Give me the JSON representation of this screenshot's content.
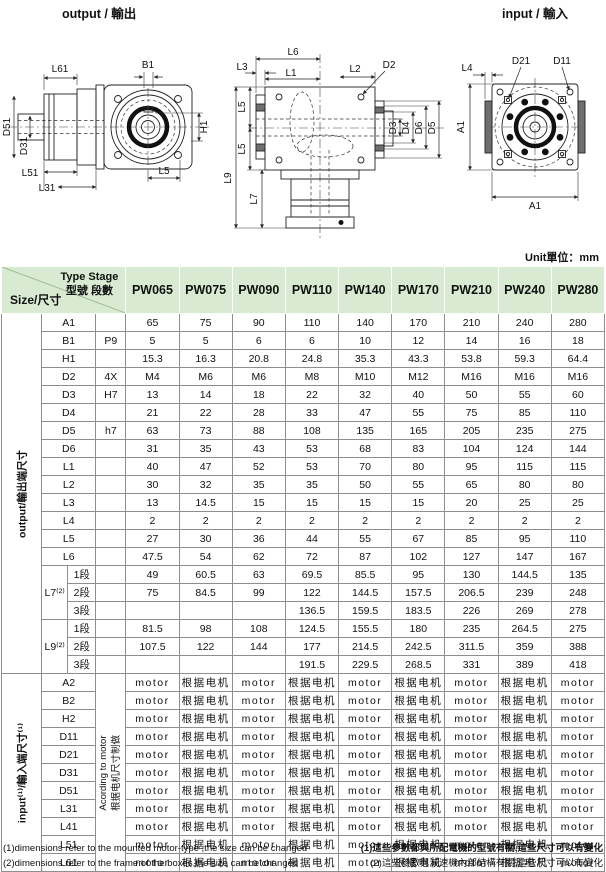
{
  "drawings": {
    "output_view": {
      "title": "output / 輸出",
      "labels": {
        "L61": "L61",
        "D51": "D51",
        "D31": "D31",
        "L51": "L51",
        "L31": "L31",
        "B1": "B1",
        "H1": "H1",
        "L5": "L5"
      }
    },
    "side_view": {
      "labels": {
        "L6": "L6",
        "L3": "L3",
        "L1": "L1",
        "L2": "L2",
        "D2": "D2",
        "L5_upper": "L5",
        "L5_lower": "L5",
        "L9": "L9",
        "L7": "L7",
        "D3": "D3",
        "D4": "D4",
        "D6": "D6",
        "D5": "D5"
      }
    },
    "input_view": {
      "title": "input / 輸入",
      "labels": {
        "L4": "L4",
        "D21": "D21",
        "D11": "D11",
        "A1_left": "A1",
        "A1_bottom": "A1"
      }
    }
  },
  "table": {
    "unit_label": "Unit單位：mm",
    "corner": {
      "type_stage_en": "Type Stage",
      "type_stage_zh": "型號 段數",
      "size_label": "Size/尺寸"
    },
    "columns": [
      "PW065",
      "PW075",
      "PW090",
      "PW110",
      "PW140",
      "PW170",
      "PW210",
      "PW240",
      "PW280"
    ],
    "output_section": {
      "label": "output/輸出端尺寸",
      "rows": [
        {
          "name": "A1",
          "qual": "",
          "values": [
            "65",
            "75",
            "90",
            "110",
            "140",
            "170",
            "210",
            "240",
            "280"
          ]
        },
        {
          "name": "B1",
          "qual": "P9",
          "values": [
            "5",
            "5",
            "6",
            "6",
            "10",
            "12",
            "14",
            "16",
            "18"
          ]
        },
        {
          "name": "H1",
          "qual": "",
          "values": [
            "15.3",
            "16.3",
            "20.8",
            "24.8",
            "35.3",
            "43.3",
            "53.8",
            "59.3",
            "64.4"
          ]
        },
        {
          "name": "D2",
          "qual": "4X",
          "values": [
            "M4",
            "M6",
            "M6",
            "M8",
            "M10",
            "M12",
            "M16",
            "M16",
            "M16"
          ]
        },
        {
          "name": "D3",
          "qual": "H7",
          "values": [
            "13",
            "14",
            "18",
            "22",
            "32",
            "40",
            "50",
            "55",
            "60"
          ]
        },
        {
          "name": "D4",
          "qual": "",
          "values": [
            "21",
            "22",
            "28",
            "33",
            "47",
            "55",
            "75",
            "85",
            "110"
          ]
        },
        {
          "name": "D5",
          "qual": "h7",
          "values": [
            "63",
            "73",
            "88",
            "108",
            "135",
            "165",
            "205",
            "235",
            "275"
          ]
        },
        {
          "name": "D6",
          "qual": "",
          "values": [
            "31",
            "35",
            "43",
            "53",
            "68",
            "83",
            "104",
            "124",
            "144"
          ]
        },
        {
          "name": "L1",
          "qual": "",
          "values": [
            "40",
            "47",
            "52",
            "53",
            "70",
            "80",
            "95",
            "115",
            "115"
          ]
        },
        {
          "name": "L2",
          "qual": "",
          "values": [
            "30",
            "32",
            "35",
            "35",
            "50",
            "55",
            "65",
            "80",
            "80"
          ]
        },
        {
          "name": "L3",
          "qual": "",
          "values": [
            "13",
            "14.5",
            "15",
            "15",
            "15",
            "15",
            "20",
            "25",
            "25"
          ]
        },
        {
          "name": "L4",
          "qual": "",
          "values": [
            "2",
            "2",
            "2",
            "2",
            "2",
            "2",
            "2",
            "2",
            "2"
          ]
        },
        {
          "name": "L5",
          "qual": "",
          "values": [
            "27",
            "30",
            "36",
            "44",
            "55",
            "67",
            "85",
            "95",
            "110"
          ]
        },
        {
          "name": "L6",
          "qual": "",
          "values": [
            "47.5",
            "54",
            "62",
            "72",
            "87",
            "102",
            "127",
            "147",
            "167"
          ]
        }
      ],
      "groups": [
        {
          "name": "L7⁽²⁾",
          "subrows": [
            {
              "label": "1段",
              "values": [
                "49",
                "60.5",
                "63",
                "69.5",
                "85.5",
                "95",
                "130",
                "144.5",
                "135"
              ]
            },
            {
              "label": "2段",
              "values": [
                "75",
                "84.5",
                "99",
                "122",
                "144.5",
                "157.5",
                "206.5",
                "239",
                "248"
              ]
            },
            {
              "label": "3段",
              "values": [
                "",
                "",
                "",
                "136.5",
                "159.5",
                "183.5",
                "226",
                "269",
                "278"
              ],
              "gray_cols": [
                0,
                1,
                2
              ]
            }
          ]
        },
        {
          "name": "L9⁽²⁾",
          "subrows": [
            {
              "label": "1段",
              "values": [
                "81.5",
                "98",
                "108",
                "124.5",
                "155.5",
                "180",
                "235",
                "264.5",
                "275"
              ]
            },
            {
              "label": "2段",
              "values": [
                "107.5",
                "122",
                "144",
                "177",
                "214.5",
                "242.5",
                "311.5",
                "359",
                "388"
              ]
            },
            {
              "label": "3段",
              "values": [
                "",
                "",
                "",
                "191.5",
                "229.5",
                "268.5",
                "331",
                "389",
                "418"
              ],
              "gray_cols": [
                0,
                1,
                2
              ]
            }
          ]
        }
      ]
    },
    "input_section": {
      "label": "input⁽¹⁾/輸入端尺寸⁽¹⁾",
      "qual_note_en": "Acording to motor",
      "qual_note_zh": "根据电机尺寸制做",
      "row_names": [
        "A2",
        "B2",
        "H2",
        "D11",
        "D21",
        "D31",
        "D51",
        "L31",
        "L41",
        "L51",
        "L61"
      ],
      "cell_pattern": [
        "motor",
        "根据电机",
        "motor",
        "根据电机",
        "motor",
        "根据电机",
        "motor",
        "根据电机",
        "motor"
      ]
    }
  },
  "footnotes": {
    "en1": "(1)dimensions refer to the mounted motor-type ,the size can be changed",
    "en2": "(2)dimensions refer to the frame of the boxes,the size can be changed",
    "zh1": "(1)這些參數都與所配電機的型號有關,這些尺寸可以有變化",
    "zh2": "(2)這些參數與減速機內部結構有關,這些尺寸可以有變化"
  },
  "colors": {
    "header_bg": "#d8ebd2",
    "gray_cell": "#c3c3c3",
    "diag_line": "#9db98f"
  }
}
